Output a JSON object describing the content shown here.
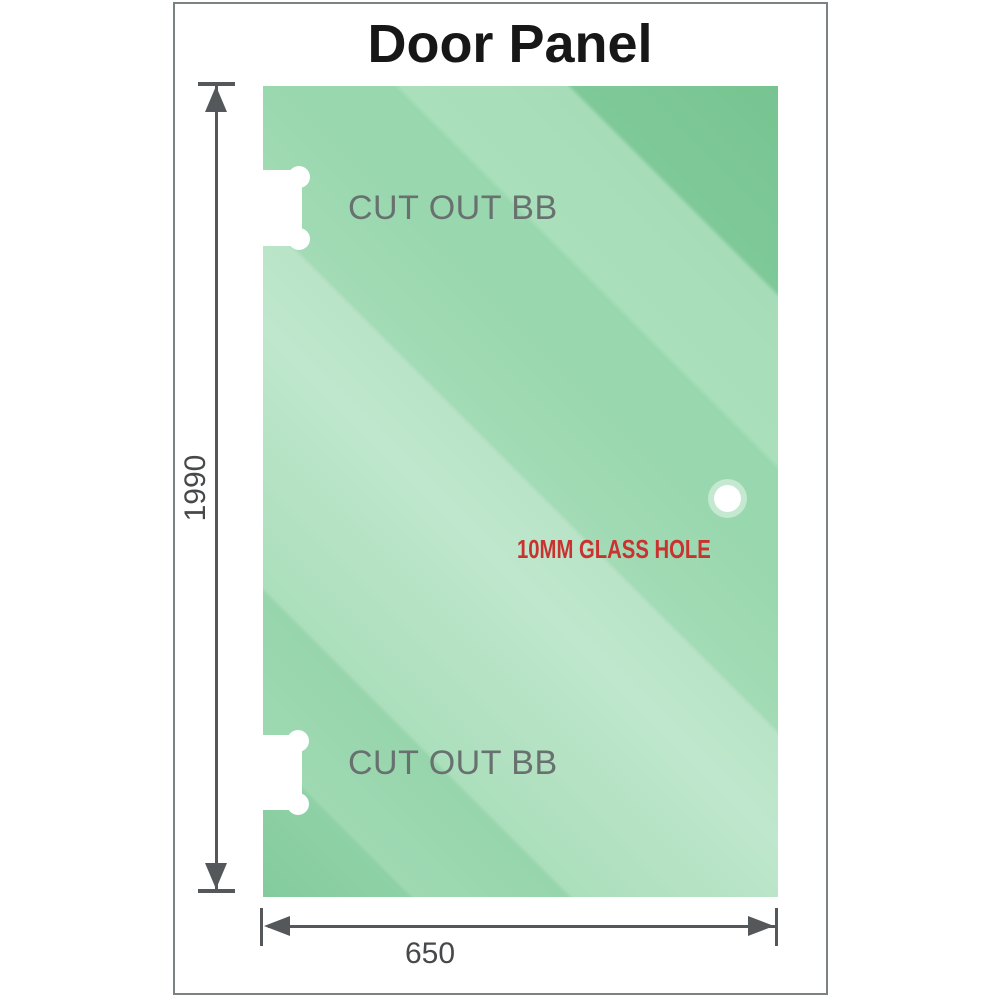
{
  "title": "Door Panel",
  "diagram": {
    "height_label": "1990",
    "width_label": "650",
    "cutout_top_label": "CUT OUT BB",
    "cutout_bottom_label": "CUT OUT BB",
    "hole_label": "10MM GLASS HOLE",
    "colors": {
      "glass_green_mid": "#99d7ae",
      "glass_green_light": "#bfe7cd",
      "glass_green_dark": "#77c491",
      "dimension_gray": "#54585b",
      "cutout_label_gray": "#68716f",
      "hole_label_red": "#c93230"
    }
  }
}
